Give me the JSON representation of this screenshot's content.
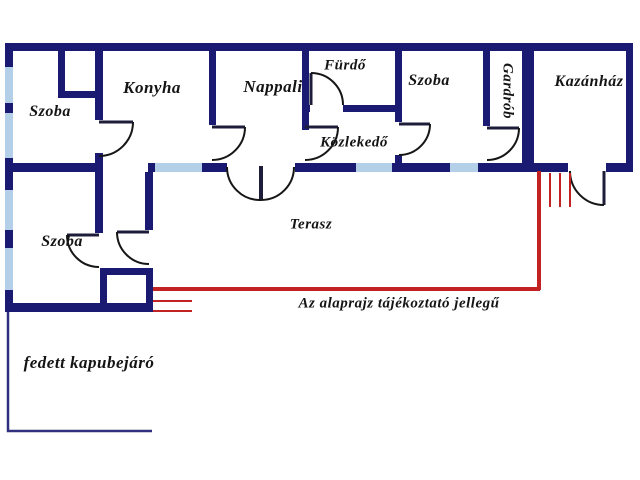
{
  "plan": {
    "rooms": [
      {
        "id": "szoba-upper-left",
        "label": "Szoba"
      },
      {
        "id": "konyha",
        "label": "Konyha"
      },
      {
        "id": "nappali",
        "label": "Nappali"
      },
      {
        "id": "furdo",
        "label": "Fürdő"
      },
      {
        "id": "szoba-middle",
        "label": "Szoba"
      },
      {
        "id": "gardrob",
        "label": "Gardrób"
      },
      {
        "id": "kazanhaz",
        "label": "Kazánház"
      },
      {
        "id": "kozlekedo",
        "label": "Közlekedő"
      },
      {
        "id": "szoba-lower-left",
        "label": "Szoba"
      },
      {
        "id": "terasz",
        "label": "Terasz"
      },
      {
        "id": "fedett-kapubejaro",
        "label": "fedett kapubejáró"
      }
    ],
    "disclaimer": "Az alaprajz tájékoztató jellegű",
    "colors": {
      "wall": "#1a1a73",
      "window": "#b4cfe8",
      "accent_red": "#c22222",
      "outline_thin": "#30307e",
      "text": "#141414",
      "background": "#ffffff"
    }
  }
}
